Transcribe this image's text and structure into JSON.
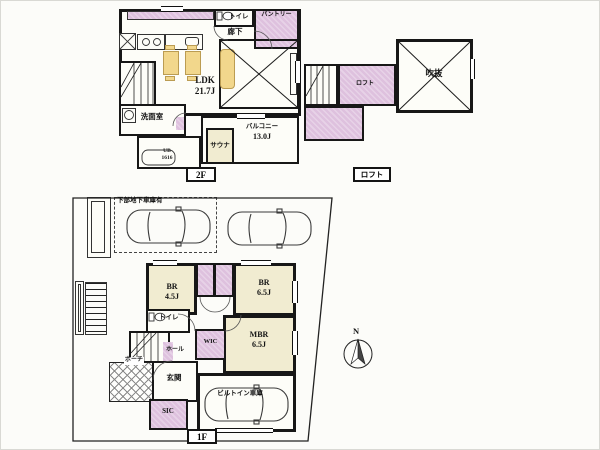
{
  "meta": {
    "doc_type": "floor-plan"
  },
  "colors": {
    "wall": "#171717",
    "room_accent_purple": "#dec1de",
    "room_cream": "#f1ecd1",
    "furniture_yellow": "#f2d78c"
  },
  "f2": {
    "floor_label": "2F",
    "ldk_name": "LDK",
    "ldk_size": "21.7J",
    "corridor": "廊下",
    "toilet": "トイレ",
    "pantry": "パントリー",
    "washroom": "洗面室",
    "bath_line1": "UB",
    "bath_line2": "1616",
    "sauna": "サウナ",
    "balcony_name": "バルコニー",
    "balcony_size": "13.0J"
  },
  "loft": {
    "floor_label": "ロフト",
    "loft_room": "ロフト",
    "void": "吹抜"
  },
  "f1": {
    "floor_label": "1F",
    "parking_note": "下部地下車庫有",
    "br1_name": "BR",
    "br1_size": "4.5J",
    "br2_name": "BR",
    "br2_size": "6.5J",
    "mbr_name": "MBR",
    "mbr_size": "6.5J",
    "wic": "WIC",
    "toilet": "トイレ",
    "hall": "ホール",
    "porch": "ポーチ",
    "entrance": "玄関",
    "sic": "SIC",
    "garage": "ビルトイン車庫"
  },
  "compass": {
    "north": "N"
  },
  "icons": {
    "toilet-icon": "bowl+tank shape",
    "stove-icon": "two burner circles",
    "sink-icon": "rounded basin",
    "washer-icon": "box with drum circle",
    "bathtub-icon": "rounded tub",
    "car-icon": "top-view car outline",
    "north-arrow-icon": "circle with needle"
  }
}
